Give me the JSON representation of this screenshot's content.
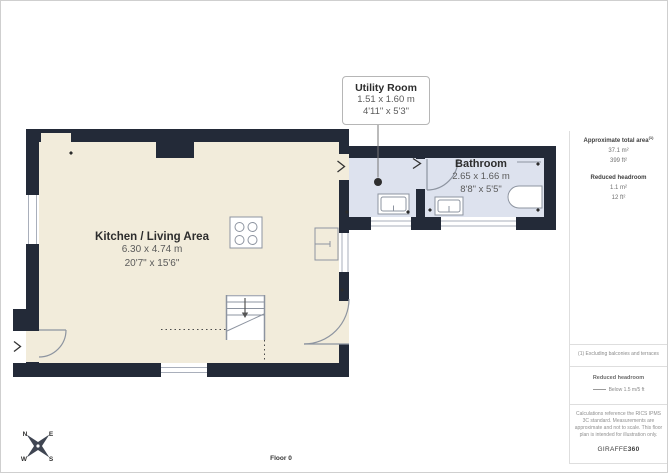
{
  "plan": {
    "floor_label": "Floor 0",
    "callout": {
      "title": "Utility Room",
      "metric": "1.51 x 1.60 m",
      "imperial": "4'11\" x 5'3\""
    },
    "rooms": {
      "kitchen": {
        "name": "Kitchen / Living Area",
        "metric": "6.30 x 4.74 m",
        "imperial": "20'7\" x 15'6\""
      },
      "bathroom": {
        "name": "Bathroom",
        "metric": "2.65 x 1.66 m",
        "imperial": "8'8\" x 5'5\""
      }
    },
    "compass": {
      "n": "N",
      "e": "E",
      "s": "S",
      "w": "W"
    }
  },
  "sidebar": {
    "area": {
      "label": "Approximate total area",
      "sup": "(1)",
      "m2": "37.1 m²",
      "ft2": "399 ft²"
    },
    "headroom": {
      "label": "Reduced headroom",
      "m2": "1.1 m²",
      "ft2": "12 ft²"
    },
    "note": "(1) Excluding balconies and terraces",
    "legend": {
      "title": "Reduced headroom",
      "item": "Below 1.5 m/5 ft"
    },
    "disclaimer": "Calculations reference the RICS IPMS 3C standard. Measurements are approximate and not to scale. This floor plan is intended for illustration only.",
    "logo": {
      "name": "GIRAFFE",
      "suffix": "360"
    }
  },
  "colors": {
    "wall": "#232a38",
    "room_main": "#f2ecdb",
    "room_wet": "#dde2ee",
    "fixture_line": "#8d94a0"
  }
}
